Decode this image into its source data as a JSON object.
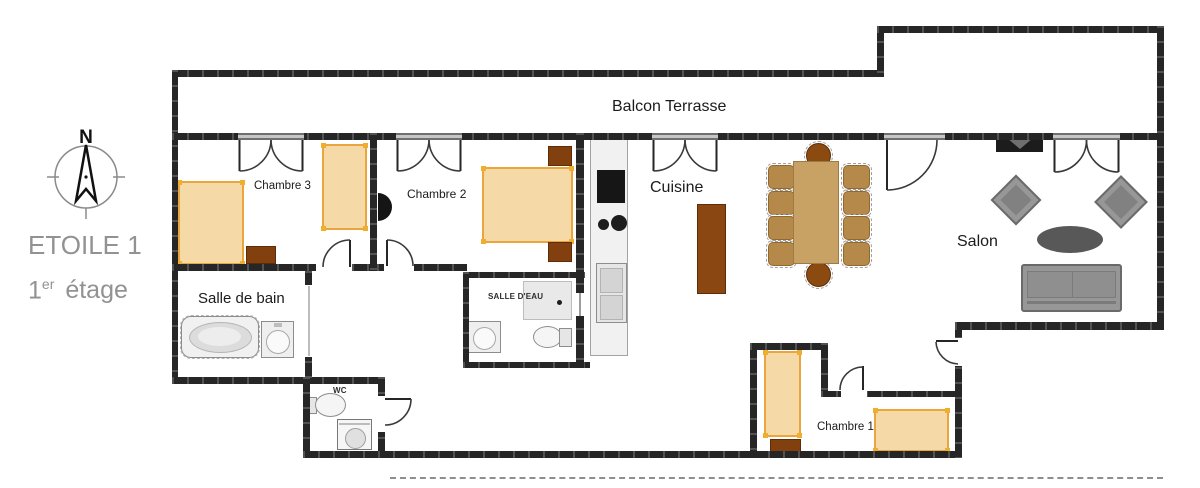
{
  "header": {
    "building_name": "ETOILE 1",
    "floor_number": "1",
    "floor_ordinal": "er",
    "floor_word": "étage"
  },
  "compass": {
    "north": "N"
  },
  "rooms": {
    "balcony": {
      "label": "Balcon Terrasse"
    },
    "bedroom3": {
      "label": "Chambre 3"
    },
    "bedroom2": {
      "label": "Chambre 2"
    },
    "kitchen": {
      "label": "Cuisine"
    },
    "living_room": {
      "label": "Salon"
    },
    "bathroom": {
      "label": "Salle de bain"
    },
    "shower_room": {
      "label": "SALLE D'EAU"
    },
    "toilet": {
      "label": "WC"
    },
    "bedroom1": {
      "label": "Chambre 1"
    }
  },
  "colors": {
    "wall": "#262626",
    "bed_fill": "#f5d9a6",
    "bed_border": "#eaa63c",
    "wood_dark": "#82400e",
    "dining_table": "#c8a164",
    "dining_chair": "#b5894a",
    "gray_furniture": "#979797",
    "title_gray": "#929292",
    "label_dark": "#1b1b1b"
  }
}
